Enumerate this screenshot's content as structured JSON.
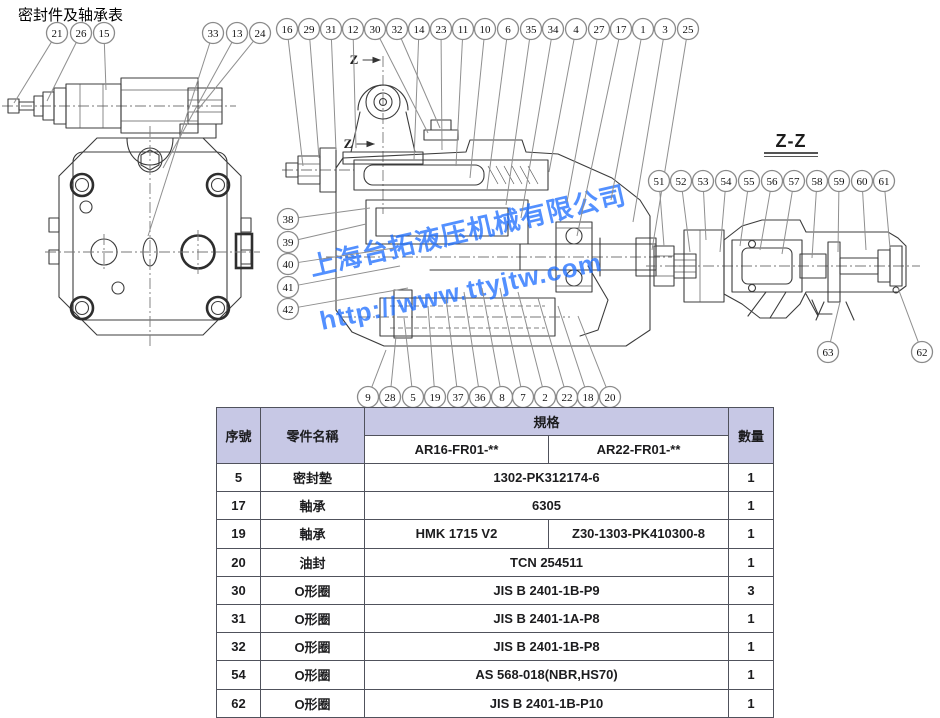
{
  "title": "密封件及轴承表",
  "section_label": "Z-Z",
  "z_marker": "Z",
  "watermark": {
    "line1": "上海台拓液压机械有限公司",
    "line2": "http://www.ttyjtw.com",
    "color": "#1a6cff"
  },
  "colors": {
    "table_header_bg": "#c7c8e5",
    "drawing_line": "#3c3c3c",
    "balloon_stroke": "#8a8a8a"
  },
  "table": {
    "headers": {
      "col_seq": "序號",
      "col_name": "零件名稱",
      "col_spec": "規格",
      "col_qty": "數量",
      "spec_sub": [
        "AR16-FR01-**",
        "AR22-FR01-**"
      ]
    },
    "rows": [
      {
        "seq": "5",
        "name": "密封墊",
        "spec": "1302-PK312174-6",
        "qty": "1"
      },
      {
        "seq": "17",
        "name": "軸承",
        "spec": "6305",
        "qty": "1"
      },
      {
        "seq": "19",
        "name": "軸承",
        "spec": "HMK 1715 V2",
        "spec2": "Z30-1303-PK410300-8",
        "qty": "1"
      },
      {
        "seq": "20",
        "name": "油封",
        "spec": "TCN 254511",
        "qty": "1"
      },
      {
        "seq": "30",
        "name": "O形圈",
        "spec": "JIS B 2401-1B-P9",
        "qty": "3"
      },
      {
        "seq": "31",
        "name": "O形圈",
        "spec": "JIS B 2401-1A-P8",
        "qty": "1"
      },
      {
        "seq": "32",
        "name": "O形圈",
        "spec": "JIS B 2401-1B-P8",
        "qty": "1"
      },
      {
        "seq": "54",
        "name": "O形圈",
        "spec": "AS 568-018(NBR,HS70)",
        "qty": "1"
      },
      {
        "seq": "62",
        "name": "O形圈",
        "spec": "JIS B 2401-1B-P10",
        "qty": "1"
      }
    ]
  },
  "balloons": [
    {
      "n": "21",
      "x": 57,
      "y": 33,
      "tx": 14,
      "ty": 103
    },
    {
      "n": "26",
      "x": 81,
      "y": 33,
      "tx": 47,
      "ty": 101
    },
    {
      "n": "15",
      "x": 104,
      "y": 33,
      "tx": 106,
      "ty": 90
    },
    {
      "n": "33",
      "x": 213,
      "y": 33,
      "tx": 148,
      "ty": 236
    },
    {
      "n": "13",
      "x": 237,
      "y": 33,
      "tx": 163,
      "ty": 168
    },
    {
      "n": "24",
      "x": 260,
      "y": 33,
      "tx": 196,
      "ty": 112
    },
    {
      "n": "16",
      "x": 287,
      "y": 29,
      "tx": 303,
      "ty": 166
    },
    {
      "n": "29",
      "x": 309,
      "y": 29,
      "tx": 319,
      "ty": 158
    },
    {
      "n": "31",
      "x": 331,
      "y": 29,
      "tx": 336,
      "ty": 150
    },
    {
      "n": "12",
      "x": 353,
      "y": 29,
      "tx": 356,
      "ty": 148
    },
    {
      "n": "30",
      "x": 375,
      "y": 29,
      "tx": 428,
      "ty": 133
    },
    {
      "n": "32",
      "x": 397,
      "y": 29,
      "tx": 440,
      "ty": 128
    },
    {
      "n": "14",
      "x": 419,
      "y": 29,
      "tx": 414,
      "ty": 160
    },
    {
      "n": "23",
      "x": 441,
      "y": 29,
      "tx": 442,
      "ty": 150
    },
    {
      "n": "11",
      "x": 463,
      "y": 29,
      "tx": 456,
      "ty": 166
    },
    {
      "n": "10",
      "x": 485,
      "y": 29,
      "tx": 470,
      "ty": 178
    },
    {
      "n": "6",
      "x": 508,
      "y": 29,
      "tx": 487,
      "ty": 190
    },
    {
      "n": "35",
      "x": 531,
      "y": 29,
      "tx": 506,
      "ty": 205
    },
    {
      "n": "34",
      "x": 553,
      "y": 29,
      "tx": 521,
      "ty": 218
    },
    {
      "n": "4",
      "x": 576,
      "y": 29,
      "tx": 549,
      "ty": 172
    },
    {
      "n": "27",
      "x": 599,
      "y": 29,
      "tx": 567,
      "ty": 202
    },
    {
      "n": "17",
      "x": 621,
      "y": 29,
      "tx": 577,
      "ty": 236
    },
    {
      "n": "1",
      "x": 643,
      "y": 29,
      "tx": 611,
      "ty": 200
    },
    {
      "n": "3",
      "x": 665,
      "y": 29,
      "tx": 633,
      "ty": 222
    },
    {
      "n": "25",
      "x": 688,
      "y": 29,
      "tx": 652,
      "ty": 250
    },
    {
      "n": "38",
      "x": 288,
      "y": 219,
      "tx": 370,
      "ty": 208
    },
    {
      "n": "39",
      "x": 288,
      "y": 242,
      "tx": 366,
      "ty": 224
    },
    {
      "n": "40",
      "x": 288,
      "y": 264,
      "tx": 394,
      "ty": 248
    },
    {
      "n": "41",
      "x": 288,
      "y": 287,
      "tx": 400,
      "ty": 266
    },
    {
      "n": "42",
      "x": 288,
      "y": 309,
      "tx": 408,
      "ty": 288
    },
    {
      "n": "9",
      "x": 368,
      "y": 397,
      "tx": 386,
      "ty": 350
    },
    {
      "n": "28",
      "x": 390,
      "y": 397,
      "tx": 396,
      "ty": 336
    },
    {
      "n": "5",
      "x": 413,
      "y": 397,
      "tx": 404,
      "ty": 318
    },
    {
      "n": "19",
      "x": 435,
      "y": 397,
      "tx": 428,
      "ty": 306
    },
    {
      "n": "37",
      "x": 458,
      "y": 397,
      "tx": 446,
      "ty": 298
    },
    {
      "n": "36",
      "x": 480,
      "y": 397,
      "tx": 464,
      "ty": 292
    },
    {
      "n": "8",
      "x": 502,
      "y": 397,
      "tx": 482,
      "ty": 288
    },
    {
      "n": "7",
      "x": 523,
      "y": 397,
      "tx": 500,
      "ty": 288
    },
    {
      "n": "2",
      "x": 545,
      "y": 397,
      "tx": 518,
      "ty": 292
    },
    {
      "n": "22",
      "x": 567,
      "y": 397,
      "tx": 538,
      "ty": 298
    },
    {
      "n": "18",
      "x": 588,
      "y": 397,
      "tx": 558,
      "ty": 306
    },
    {
      "n": "20",
      "x": 610,
      "y": 397,
      "tx": 578,
      "ty": 316
    },
    {
      "n": "51",
      "x": 659,
      "y": 181,
      "tx": 664,
      "ty": 246
    },
    {
      "n": "52",
      "x": 681,
      "y": 181,
      "tx": 690,
      "ty": 252
    },
    {
      "n": "53",
      "x": 703,
      "y": 181,
      "tx": 706,
      "ty": 240
    },
    {
      "n": "54",
      "x": 726,
      "y": 181,
      "tx": 720,
      "ty": 252
    },
    {
      "n": "55",
      "x": 749,
      "y": 181,
      "tx": 740,
      "ty": 246
    },
    {
      "n": "56",
      "x": 772,
      "y": 181,
      "tx": 760,
      "ty": 250
    },
    {
      "n": "57",
      "x": 794,
      "y": 181,
      "tx": 782,
      "ty": 254
    },
    {
      "n": "58",
      "x": 817,
      "y": 181,
      "tx": 812,
      "ty": 258
    },
    {
      "n": "59",
      "x": 839,
      "y": 181,
      "tx": 838,
      "ty": 252
    },
    {
      "n": "60",
      "x": 862,
      "y": 181,
      "tx": 866,
      "ty": 250
    },
    {
      "n": "61",
      "x": 884,
      "y": 181,
      "tx": 890,
      "ty": 248
    },
    {
      "n": "63",
      "x": 828,
      "y": 352,
      "tx": 840,
      "ty": 302
    },
    {
      "n": "62",
      "x": 922,
      "y": 352,
      "tx": 898,
      "ty": 288
    }
  ]
}
